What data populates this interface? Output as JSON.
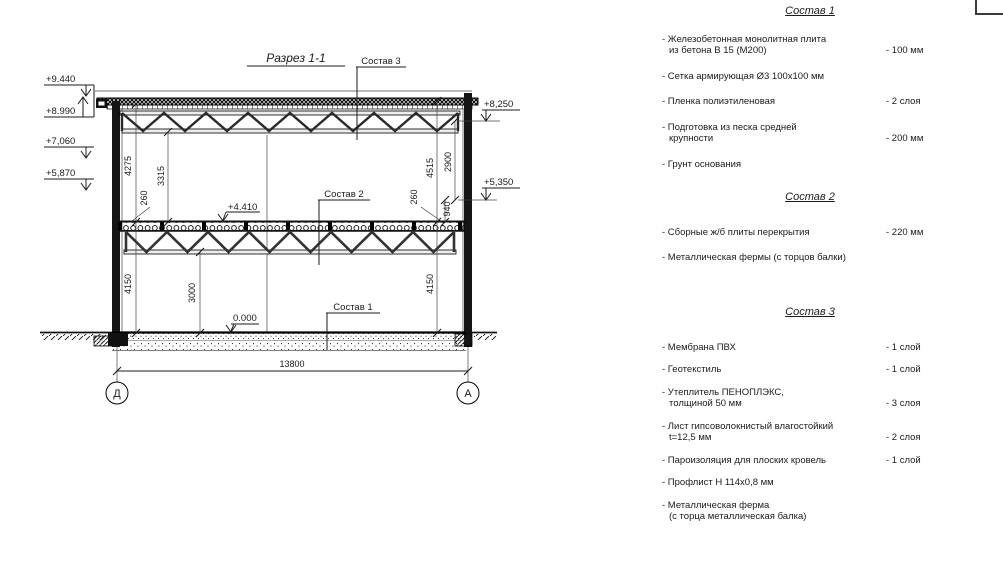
{
  "drawing": {
    "title": "Разрез 1-1",
    "axes": {
      "left": "Д",
      "right": "А"
    },
    "labels": {
      "s1": "Состав 1",
      "s2": "Состав 2",
      "s3": "Состав 3"
    },
    "elevations": {
      "p9440": "+9.440",
      "p8990": "+8.990",
      "p7060": "+7,060",
      "p5870": "+5,870",
      "p8250": "+8,250",
      "p5350": "+5,350",
      "p4410": "+4.410",
      "p0000": "0.000"
    },
    "dims": {
      "d4275": "4275",
      "d3315": "3315",
      "d260l": "260",
      "d4150l": "4150",
      "d3000": "3000",
      "d4515": "4515",
      "d2900": "2900",
      "d260r": "260",
      "d940": "940",
      "d4150r": "4150",
      "d13800": "13800"
    }
  },
  "panels": [
    {
      "title": "Состав 1",
      "items": [
        {
          "lines": [
            "- Железобетонная  монолитная плита",
            "из бетона В 15 (М200)"
          ],
          "value": "- 100 мм"
        },
        {
          "lines": [
            "- Сетка армирующая Ø3 100х100 мм"
          ],
          "value": ""
        },
        {
          "lines": [
            "- Пленка полиэтиленовая"
          ],
          "value": "- 2 слоя"
        },
        {
          "lines": [
            "- Подготовка из песка средней",
            "крупности"
          ],
          "value": "- 200 мм"
        },
        {
          "lines": [
            "- Грунт основания"
          ],
          "value": ""
        }
      ]
    },
    {
      "title": "Состав 2",
      "items": [
        {
          "lines": [
            "- Сборные ж/б плиты перекрытия"
          ],
          "value": "- 220 мм"
        },
        {
          "lines": [
            "- Металлическая фермы (с торцов балки)"
          ],
          "value": ""
        }
      ]
    },
    {
      "title": "Состав 3",
      "items": [
        {
          "lines": [
            "- Мембрана ПВХ"
          ],
          "value": "- 1 слой"
        },
        {
          "lines": [
            "- Геотекстиль"
          ],
          "value": "- 1 слой"
        },
        {
          "lines": [
            "- Утеплитель ПЕНОПЛЭКС,",
            "толщиной 50 мм"
          ],
          "value": "- 3 слоя"
        },
        {
          "lines": [
            "- Лист гипсоволокнистый влагостойкий",
            "t=12,5 мм"
          ],
          "value": "- 2 слоя"
        },
        {
          "lines": [
            "- Пароизоляция для плоских кровель"
          ],
          "value": "- 1 слой"
        },
        {
          "lines": [
            "- Профлист Н 114х0,8 мм"
          ],
          "value": ""
        },
        {
          "lines": [
            "- Металлическая ферма",
            "(с торца металлическая балка)"
          ],
          "value": ""
        }
      ]
    }
  ]
}
